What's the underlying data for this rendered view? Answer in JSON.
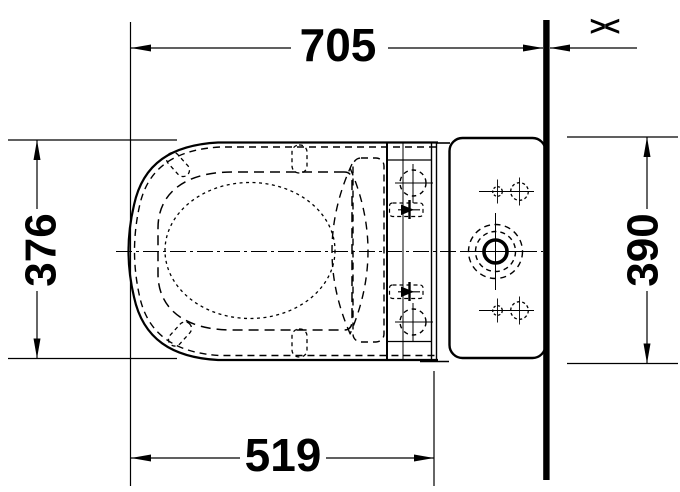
{
  "dimensions": {
    "top_width": "705",
    "seat_depth": "376",
    "tank_height": "390",
    "bowl_length": "519"
  },
  "symbols": {
    "wall_gap": "><"
  },
  "colors": {
    "line": "#000000",
    "background": "#ffffff"
  }
}
